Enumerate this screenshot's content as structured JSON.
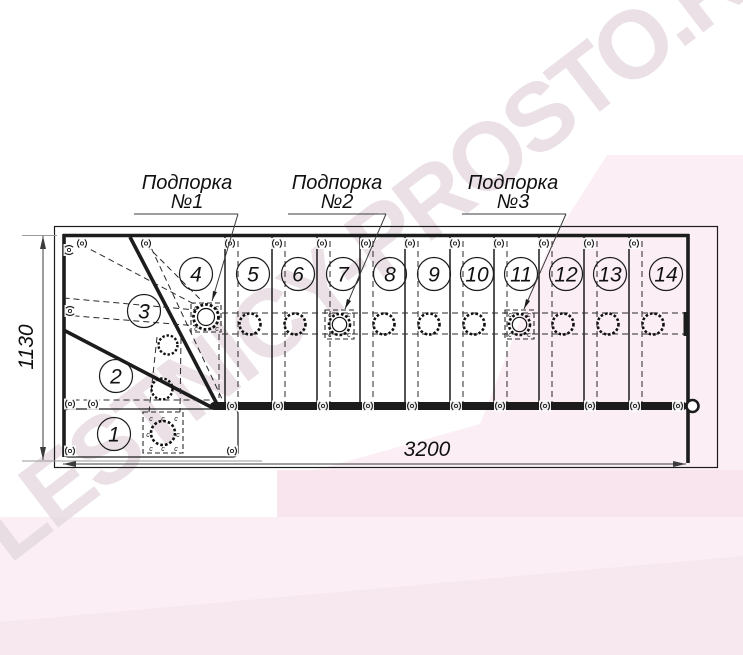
{
  "drawing": {
    "supports": [
      {
        "name": "Подпорка",
        "number": "№1"
      },
      {
        "name": "Подпорка",
        "number": "№2"
      },
      {
        "name": "Подпорка",
        "number": "№3"
      }
    ],
    "steps": [
      "1",
      "2",
      "3",
      "4",
      "5",
      "6",
      "7",
      "8",
      "9",
      "10",
      "11",
      "12",
      "13",
      "14"
    ],
    "dimensions": {
      "depth": "1130",
      "length": "3200"
    },
    "fastener_mark": "c"
  },
  "watermark": {
    "text": "LESTNICY-PROSTO.RU"
  },
  "colors": {
    "line": "#1c1c1c",
    "dimension_line": "#3c3c3c",
    "pink_band": "#fbeff5",
    "pink_block": "#f8e5ee",
    "pink_bottom": "#f7e7ef",
    "watermark_text": "#e7dbe2"
  }
}
